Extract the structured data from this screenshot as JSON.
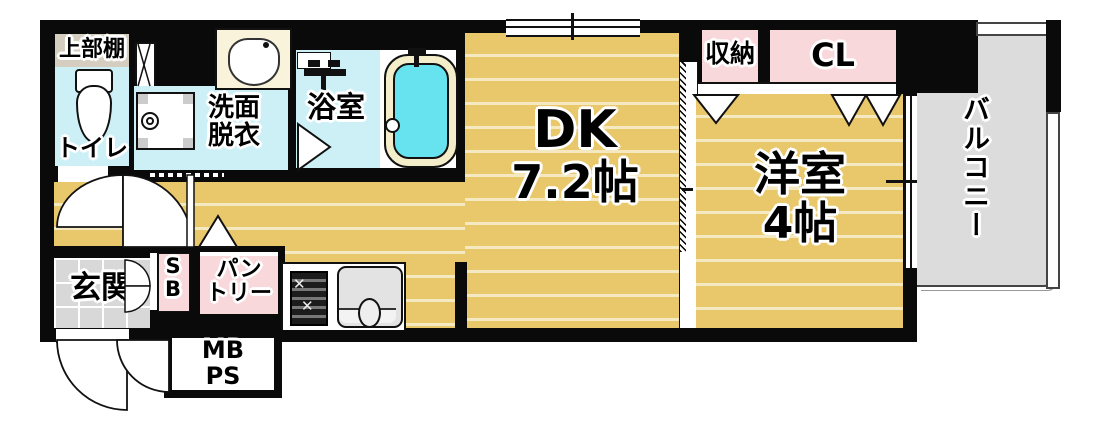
{
  "plan": {
    "title": "1DK apartment floor plan",
    "rooms": {
      "upper_shelf": {
        "label": "上部棚"
      },
      "toilet": {
        "label": "トイレ"
      },
      "washroom": {
        "line1": "洗面",
        "line2": "脱衣"
      },
      "bathroom": {
        "label": "浴室"
      },
      "dk": {
        "label": "DK",
        "size": "7.2帖"
      },
      "storage": {
        "label": "収納"
      },
      "closet": {
        "label": "CL"
      },
      "western": {
        "label": "洋室",
        "size": "4帖"
      },
      "balcony": {
        "label": "バルコニー"
      },
      "entrance": {
        "label": "玄関"
      },
      "shoebox": {
        "line1": "S",
        "line2": "B"
      },
      "pantry": {
        "line1": "パン",
        "line2": "トリー"
      },
      "mbps": {
        "line1": "MB",
        "line2": "PS"
      }
    },
    "colors": {
      "wall": "#0a0a0a",
      "wood": "#e9c76b",
      "wood_stripe": "#f4e9c0",
      "wet_floor": "#cdf0f7",
      "tub_water": "#67e3ef",
      "tub_rim": "#f3edca",
      "basin_cream": "#f8f3da",
      "pink": "#f9d8dc",
      "shelf_beige": "#d5cec0",
      "balcony_gray": "#dcdcdc",
      "tile_gray": "#d8d8d8"
    }
  }
}
